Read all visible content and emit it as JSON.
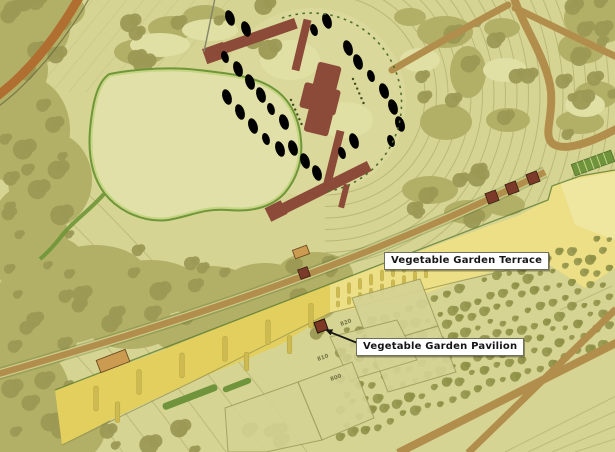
{
  "map": {
    "annotations": {
      "terrace_label": "Vegetable Garden Terrace",
      "pavilion_label": "Vegetable Garden Pavilion"
    },
    "contour_labels": [
      "820",
      "810",
      "800"
    ],
    "colors": {
      "base": "#d6d493",
      "pale": "#e0dfa4",
      "circle_fill": "#dad89b",
      "woodland": "#b2af66",
      "clump": "#9b9954",
      "scrub": "#95964e",
      "lawn": "#e1e0a8",
      "path_green": "#6f9638",
      "path_light": "#c6d584",
      "road": "#b28e4c",
      "road_orange": "#b06f30",
      "terrace_deep": "#e3cf5d",
      "terrace_light": "#ecdf85",
      "bed": "#cdbb52",
      "hedge": "#6f943c",
      "building": "#8c4a39",
      "struct_red": "#7c3a2a",
      "struct_orange": "#cb9b51",
      "contour": "#a5a361",
      "dash_green": "#4e6e2c",
      "dot": "#3f4a1f",
      "plot_fill": "#d5d394",
      "plot_line": "#a09e5c",
      "label_bg": "#ffffff",
      "label_text": "#161616",
      "arrow": "#151515"
    }
  }
}
